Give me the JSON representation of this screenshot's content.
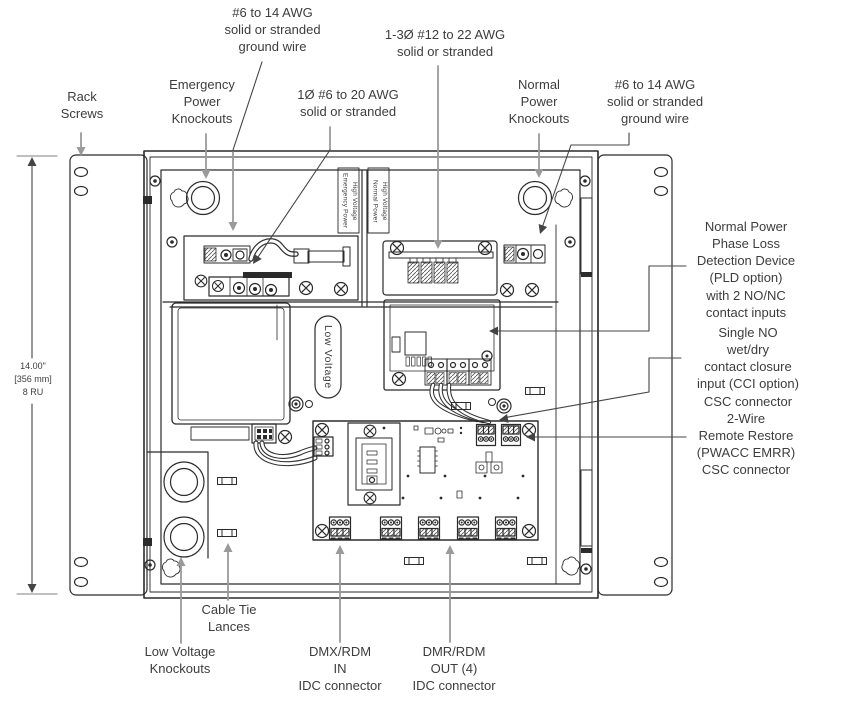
{
  "diagram_title": "Rack-mount power control enclosure wiring diagram",
  "colors": {
    "background": "#ffffff",
    "line": "#2b2b2b",
    "leader-gray": "#9a9a9a",
    "text": "#3d3d3d"
  },
  "labels": {
    "rack_screws": "Rack\nScrews",
    "emergency_knockouts": "Emergency\nPower\nKnockouts",
    "ground_wire_left": "#6 to 14 AWG\nsolid or stranded\nground wire",
    "wire_1ph": "1Ø #6 to 20 AWG\nsolid or stranded",
    "wire_3ph": "1-3Ø #12 to 22 AWG\nsolid or stranded",
    "normal_knockouts": "Normal\nPower\nKnockouts",
    "ground_wire_right": "#6 to 14 AWG\nsolid or stranded\nground wire",
    "pld": "Normal Power\nPhase Loss\nDetection Device\n(PLD option)\nwith 2 NO/NC\ncontact inputs",
    "cci": "Single NO\nwet/dry\ncontact closure\ninput (CCI option)\nCSC connector",
    "emrr": "2-Wire\nRemote Restore\n(PWACC EMRR)\nCSC connector",
    "dimension": "14.00\"\n[356 mm]\n8 RU",
    "cable_tie": "Cable Tie\nLances",
    "lv_knockouts": "Low Voltage\nKnockouts",
    "dmx_in": "DMX/RDM\nIN\nIDC connector",
    "dmr_out": "DMR/RDM\nOUT (4)\nIDC connector",
    "hv_emergency": "High Voltage\nEmergency Power",
    "hv_normal": "High Voltage\nNormal Power",
    "low_voltage": "Low Voltage"
  }
}
